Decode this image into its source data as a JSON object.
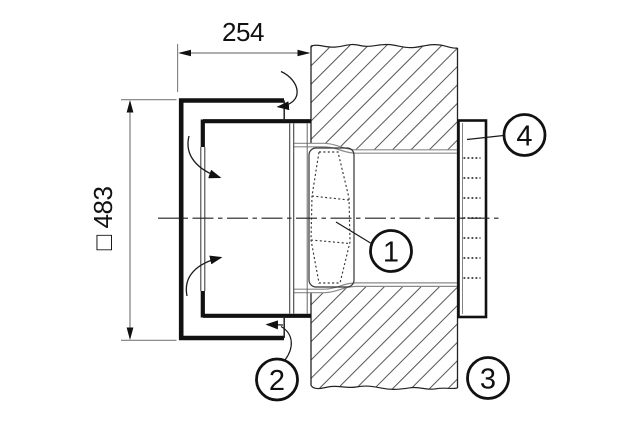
{
  "drawing": {
    "type": "technical-section-view",
    "dimension_labels": {
      "width": "254",
      "height": "□ 483"
    },
    "callout_labels": {
      "c1": "1",
      "c2": "2",
      "c3": "3",
      "c4": "4"
    },
    "colors": {
      "line": "#1a1a1a",
      "dim_line": "#7d7d7d",
      "duct_line": "#8a8a8a",
      "hatch": "#555555",
      "background": "#ffffff"
    }
  }
}
